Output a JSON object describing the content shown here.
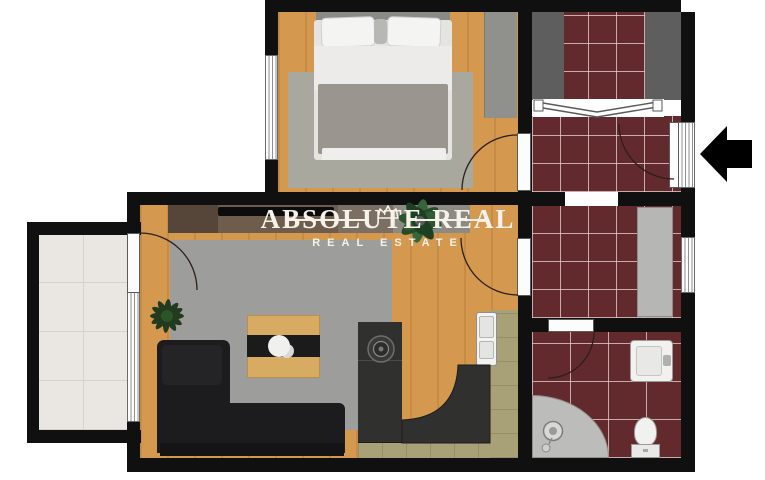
{
  "watermark": {
    "title": "ABSOLUTE REAL",
    "subtitle": "REAL ESTATE",
    "text_color": "#f6f2ea",
    "icon": "crown-icon"
  },
  "icons": {
    "crown": "crown-icon",
    "entrance_arrow": "arrow-left-icon"
  },
  "palette": {
    "wall": "#101010",
    "wood": "#d4984f",
    "red_tile": "#632a2e",
    "balcony_tile": "#eae7e2",
    "living_rug": "#9d9d9b",
    "bedroom_rug": "#a8a89e",
    "sofa": "#1c1c1e",
    "granite": "#30302e",
    "khaki": "#a8a077",
    "wardrobe_dark": "#5e5e5e",
    "closet_light": "#b6b6b4",
    "fixture_white": "#f1f1ef",
    "shower_gray": "#bcbcba",
    "watermark_text": "#f6f2ea",
    "entry_arrow": "#000000"
  }
}
